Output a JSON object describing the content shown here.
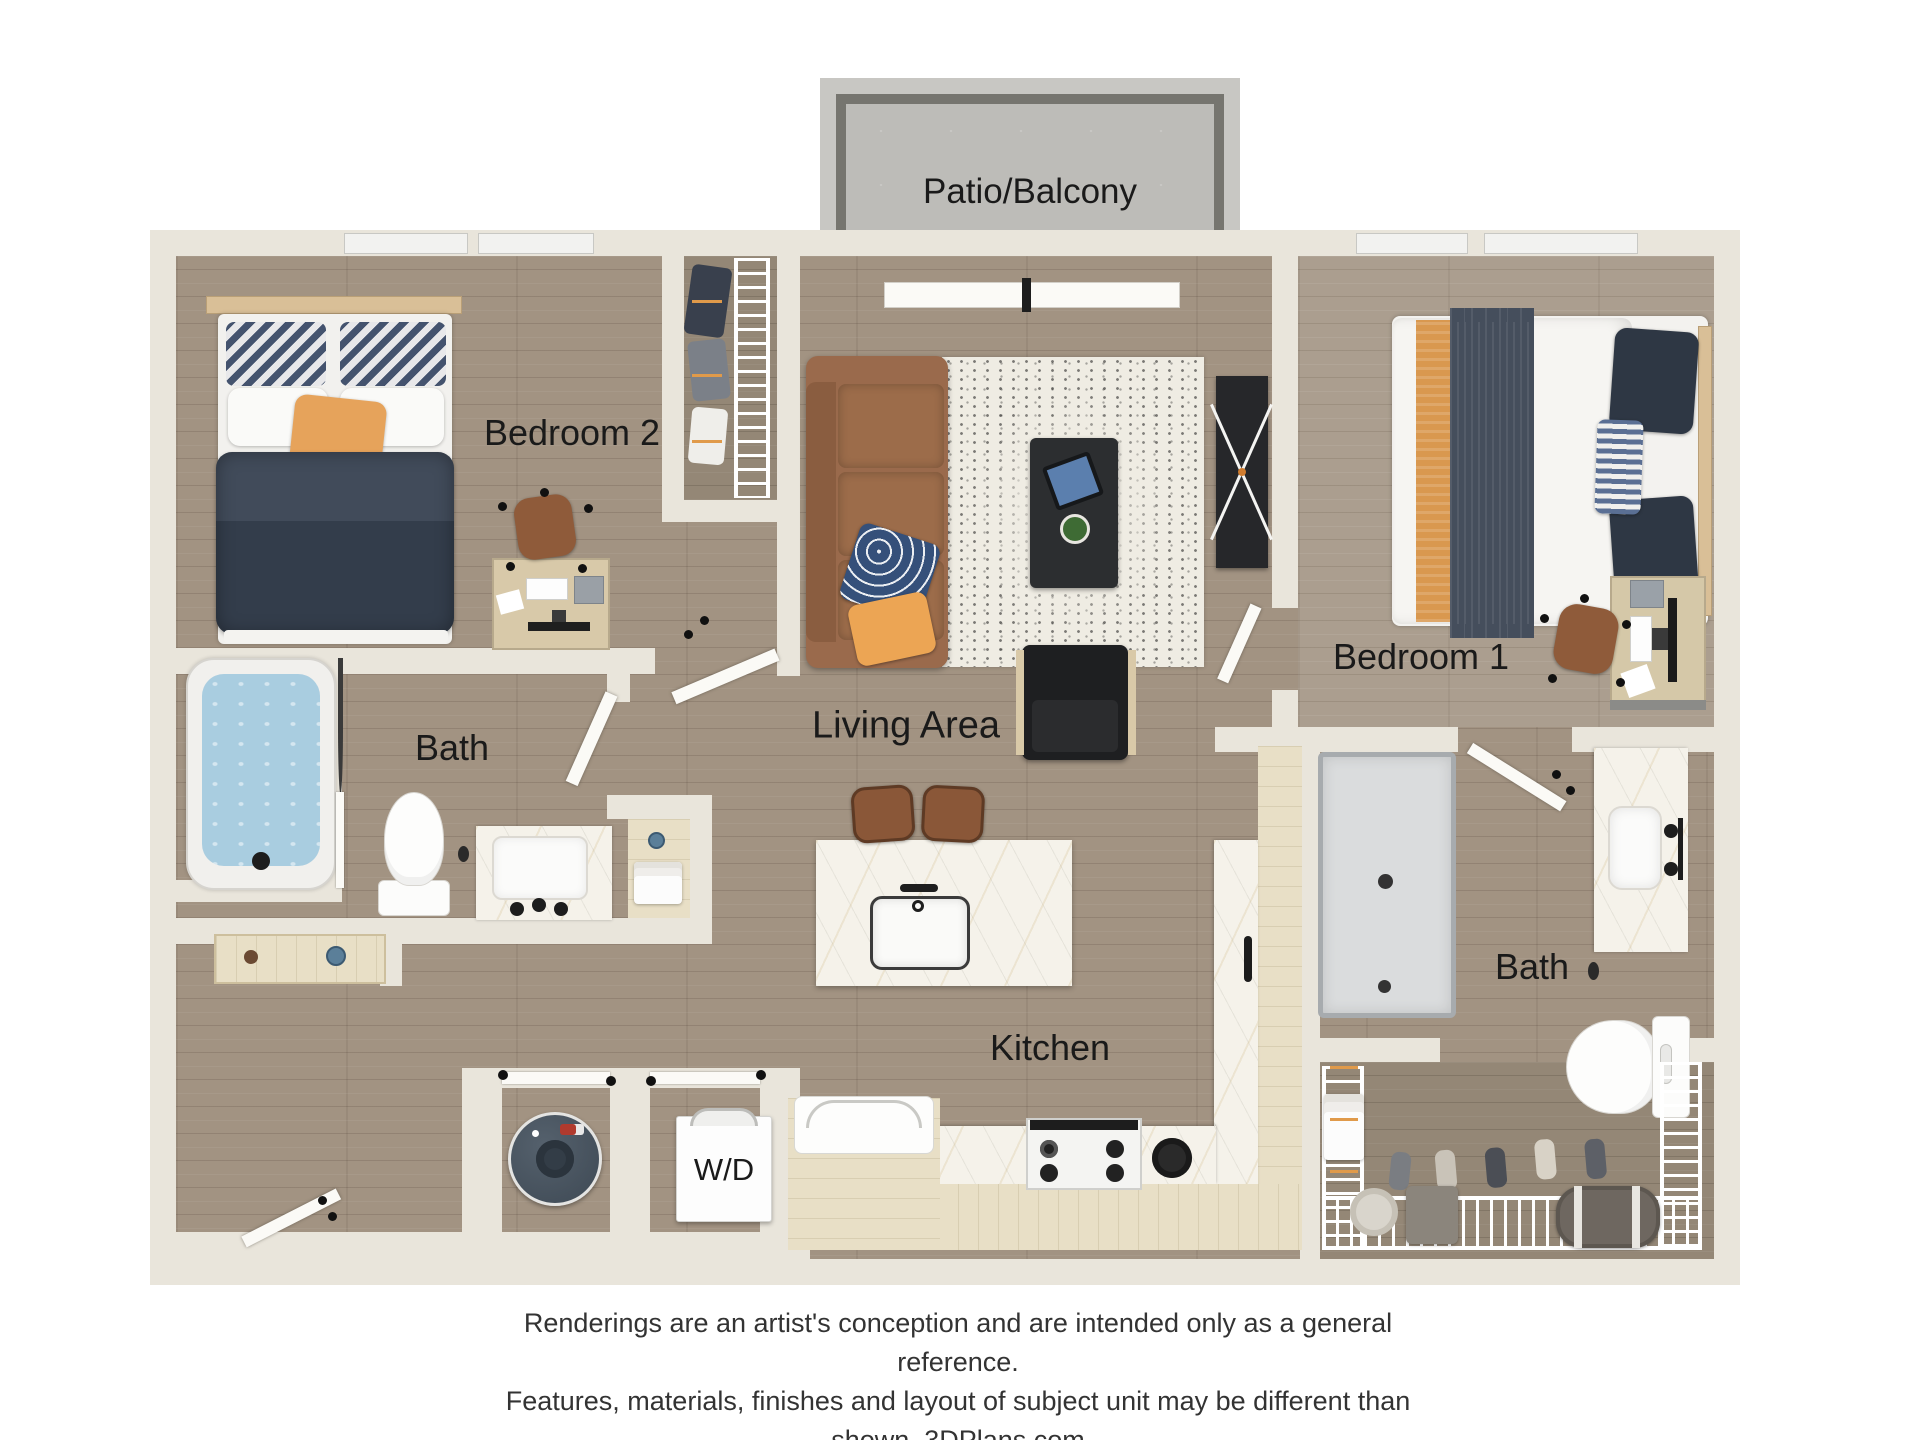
{
  "plan": {
    "rooms": {
      "patio": {
        "label": "Patio/Balcony"
      },
      "bedroom2": {
        "label": "Bedroom 2"
      },
      "bedroom1": {
        "label": "Bedroom 1"
      },
      "bath_left": {
        "label": "Bath"
      },
      "bath_right": {
        "label": "Bath"
      },
      "living": {
        "label": "Living Area"
      },
      "kitchen": {
        "label": "Kitchen"
      },
      "laundry": {
        "label": "W/D"
      }
    },
    "colors": {
      "wall": "#e9e5db",
      "floor_wood": "#a29382",
      "floor_wood_light": "#ab9e8f",
      "concrete": "#bdbcb8",
      "patio_rail": "#76756f",
      "marble": "#f5f2ea",
      "cabinet_wood": "#e8dfc6",
      "sofa_leather": "#9a6a4c",
      "duvet_navy": "#3a4452",
      "accent_orange": "#e2a35c",
      "tub_water": "#a9cde0",
      "water_heater": "#46525e",
      "label_text": "#1a1a1a"
    }
  },
  "footer": {
    "line1": "Renderings are an artist's conception and are intended only as a general reference.",
    "line2": "Features, materials, finishes and layout of subject unit may be different than shown. 3DPlans.com"
  }
}
